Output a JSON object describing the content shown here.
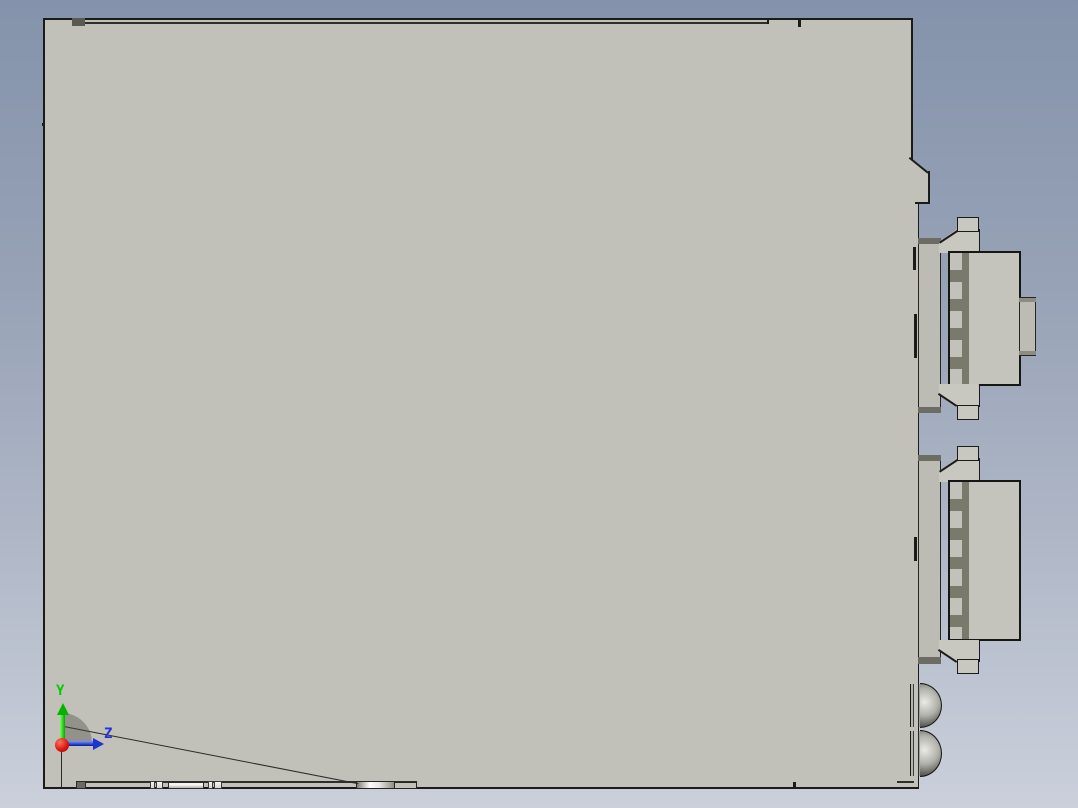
{
  "viewport": {
    "type": "cad-3d-viewport-side-view",
    "background_top": "#8493ab",
    "background_bottom": "#cbd0db",
    "model": {
      "name": "electronic-module-side-view",
      "body_color": "#c1c1b9",
      "edge_color": "#1b1b19",
      "connector_dark_color": "#7a7a6c",
      "plate_band_color": "#6c6c64",
      "connector_count": 2,
      "dome_fastener_count": 2
    },
    "triad": {
      "y_label": "Y",
      "z_label": "Z",
      "y_color": "#00cc00",
      "z_color": "#2233dd",
      "origin_color": "#dd1410"
    }
  }
}
